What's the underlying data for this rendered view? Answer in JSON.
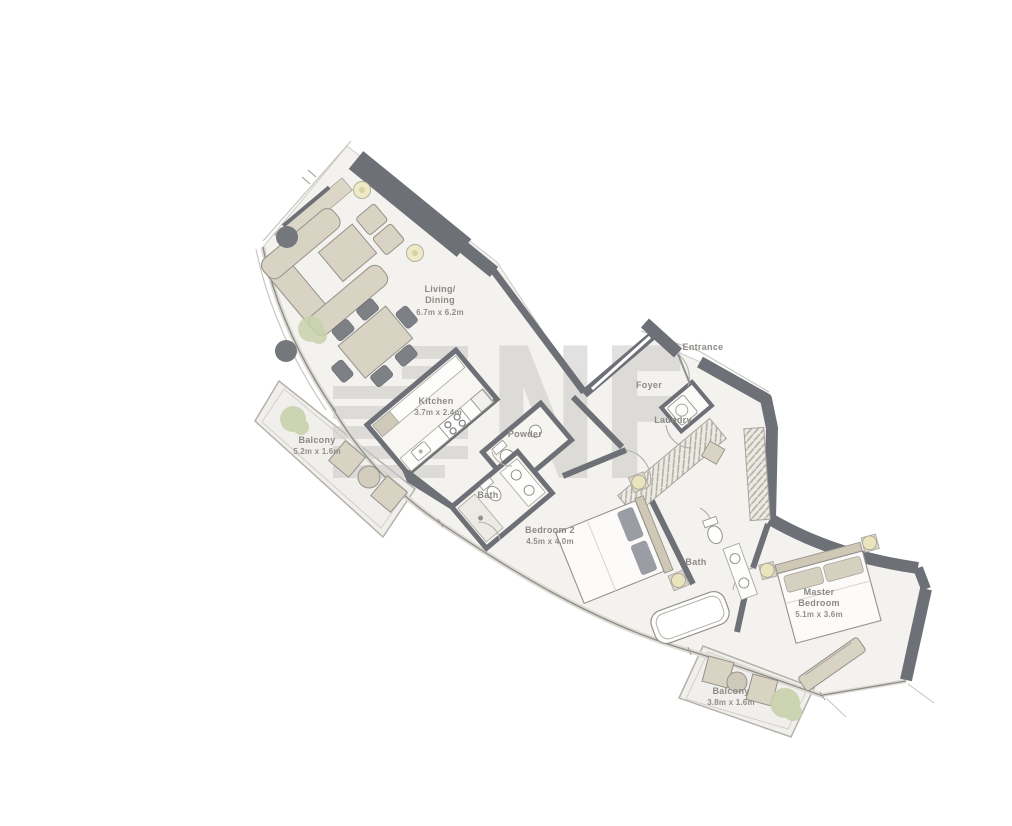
{
  "colors": {
    "wall": "#6d7076",
    "floor": "#f3f2ee",
    "balcony_floor": "#f0efeb",
    "furniture": "#d9d3c4",
    "plant": "#c9d2ac",
    "watermark": "#cbc9c5",
    "label_text": "#8c8a85",
    "background": "#ffffff"
  },
  "floorplan": {
    "watermark": {
      "text": "NF"
    },
    "rooms": {
      "living": {
        "line1": "Living/",
        "line2": "Dining",
        "dims": "6.7m x 6.2m"
      },
      "kitchen": {
        "line1": "Kitchen",
        "dims": "3.7m x 2.4m"
      },
      "balcony_left": {
        "line1": "Balcony",
        "dims": "5.2m x 1.6m"
      },
      "powder": {
        "line1": "Powder"
      },
      "bath_1": {
        "line1": "Bath"
      },
      "bedroom_2": {
        "line1": "Bedroom 2",
        "dims": "4.5m x 4.0m"
      },
      "entrance": {
        "line1": "Entrance"
      },
      "foyer": {
        "line1": "Foyer"
      },
      "laundry": {
        "line1": "Laundry"
      },
      "bath_2": {
        "line1": "Bath"
      },
      "master_bedroom": {
        "line1": "Master",
        "line2": "Bedroom",
        "dims": "5.1m x 3.6m"
      },
      "balcony_bottom": {
        "line1": "Balcony",
        "dims": "3.8m x 1.6m"
      }
    }
  }
}
